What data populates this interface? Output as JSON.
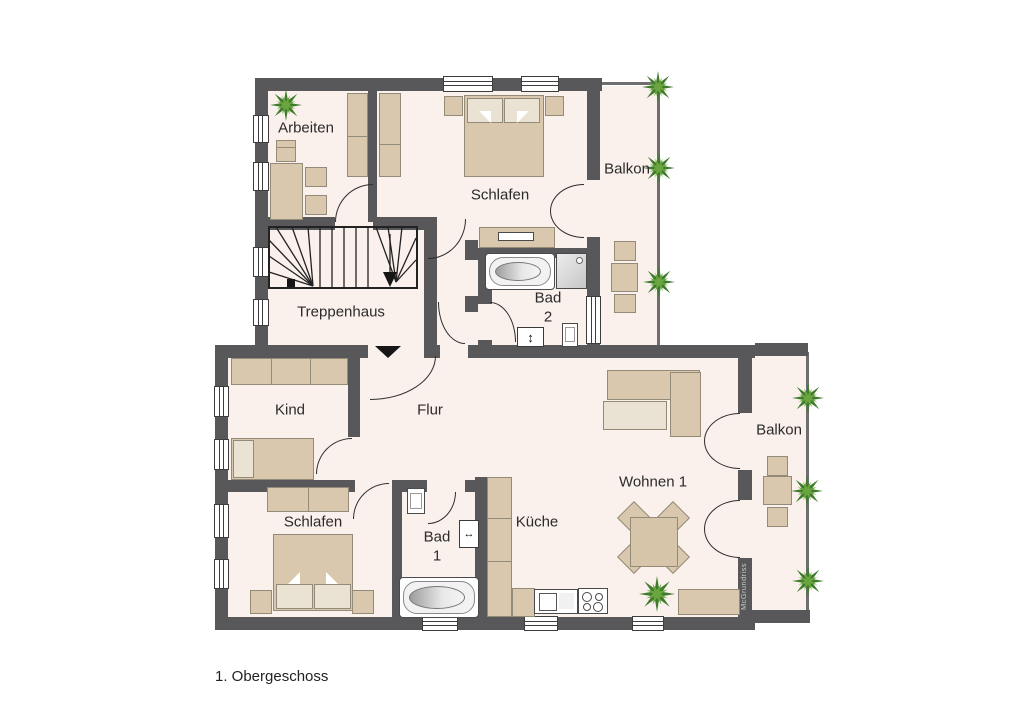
{
  "title": "1. Obergeschoss",
  "watermark": "McGrundriss",
  "rooms": {
    "arbeiten": {
      "label": "Arbeiten"
    },
    "schlafen_top": {
      "label": "Schlafen"
    },
    "balkon_top": {
      "label": "Balkon"
    },
    "treppenhaus": {
      "label": "Treppenhaus"
    },
    "bad_2": {
      "label": "Bad",
      "number": "2"
    },
    "kind": {
      "label": "Kind"
    },
    "flur": {
      "label": "Flur"
    },
    "schlafen_unten": {
      "label": "Schlafen"
    },
    "bad_1": {
      "label": "Bad",
      "number": "1"
    },
    "kueche": {
      "label": "Küche"
    },
    "wohnen": {
      "label": "Wohnen 1"
    },
    "balkon_rechts": {
      "label": "Balkon"
    }
  },
  "symbols": {
    "bad2_appliance": "↕",
    "bad1_appliance": "↔"
  },
  "colors": {
    "wall": "#58585a",
    "floor": "#faf0ec",
    "furniture": "#d9c8ad",
    "furniture_light": "#eae2d2",
    "fixture_white": "#ffffff",
    "plant_dark": "#3f7d2c",
    "plant_light": "#6aa53f",
    "background": "#ffffff"
  }
}
